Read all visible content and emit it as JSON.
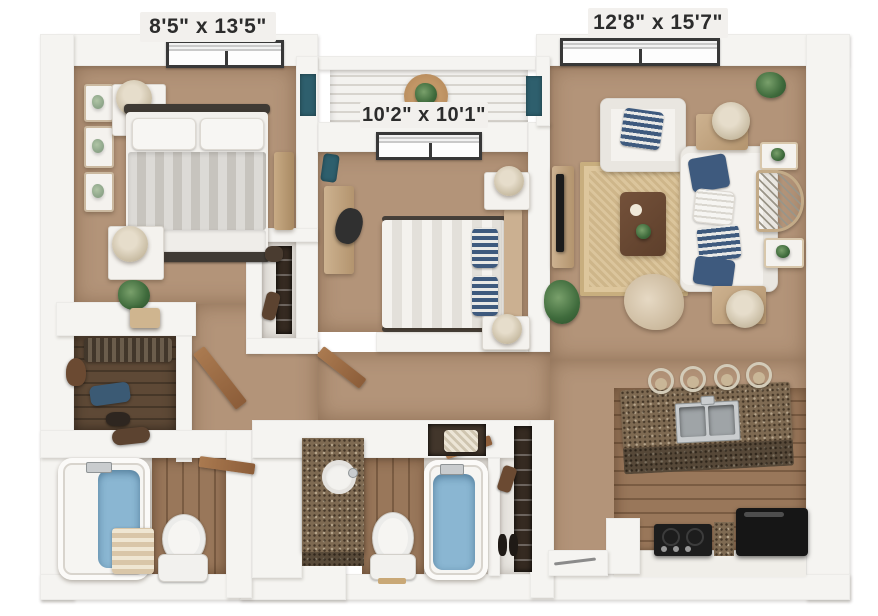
{
  "labels": {
    "bedroom_left": "8'5\" x 13'5\"",
    "bedroom_middle": "10'2\" x 10'1\"",
    "living_room": "12'8\" x 15'7\""
  },
  "colors": {
    "page_background": "#ffffff",
    "wall": "#f5f4f1",
    "carpet": "#b39479",
    "wood_floor": "#99775a",
    "dark_wood_floor": "#5e4936",
    "rug": "#d8c094",
    "water": "#8ab6d2",
    "granite": "#7e6a52",
    "teal_accent": "#2e5f6d",
    "navy_pillow": "#3e5a7e",
    "label_text": "#2c2c2c",
    "label_background": "#f2f0ed"
  }
}
